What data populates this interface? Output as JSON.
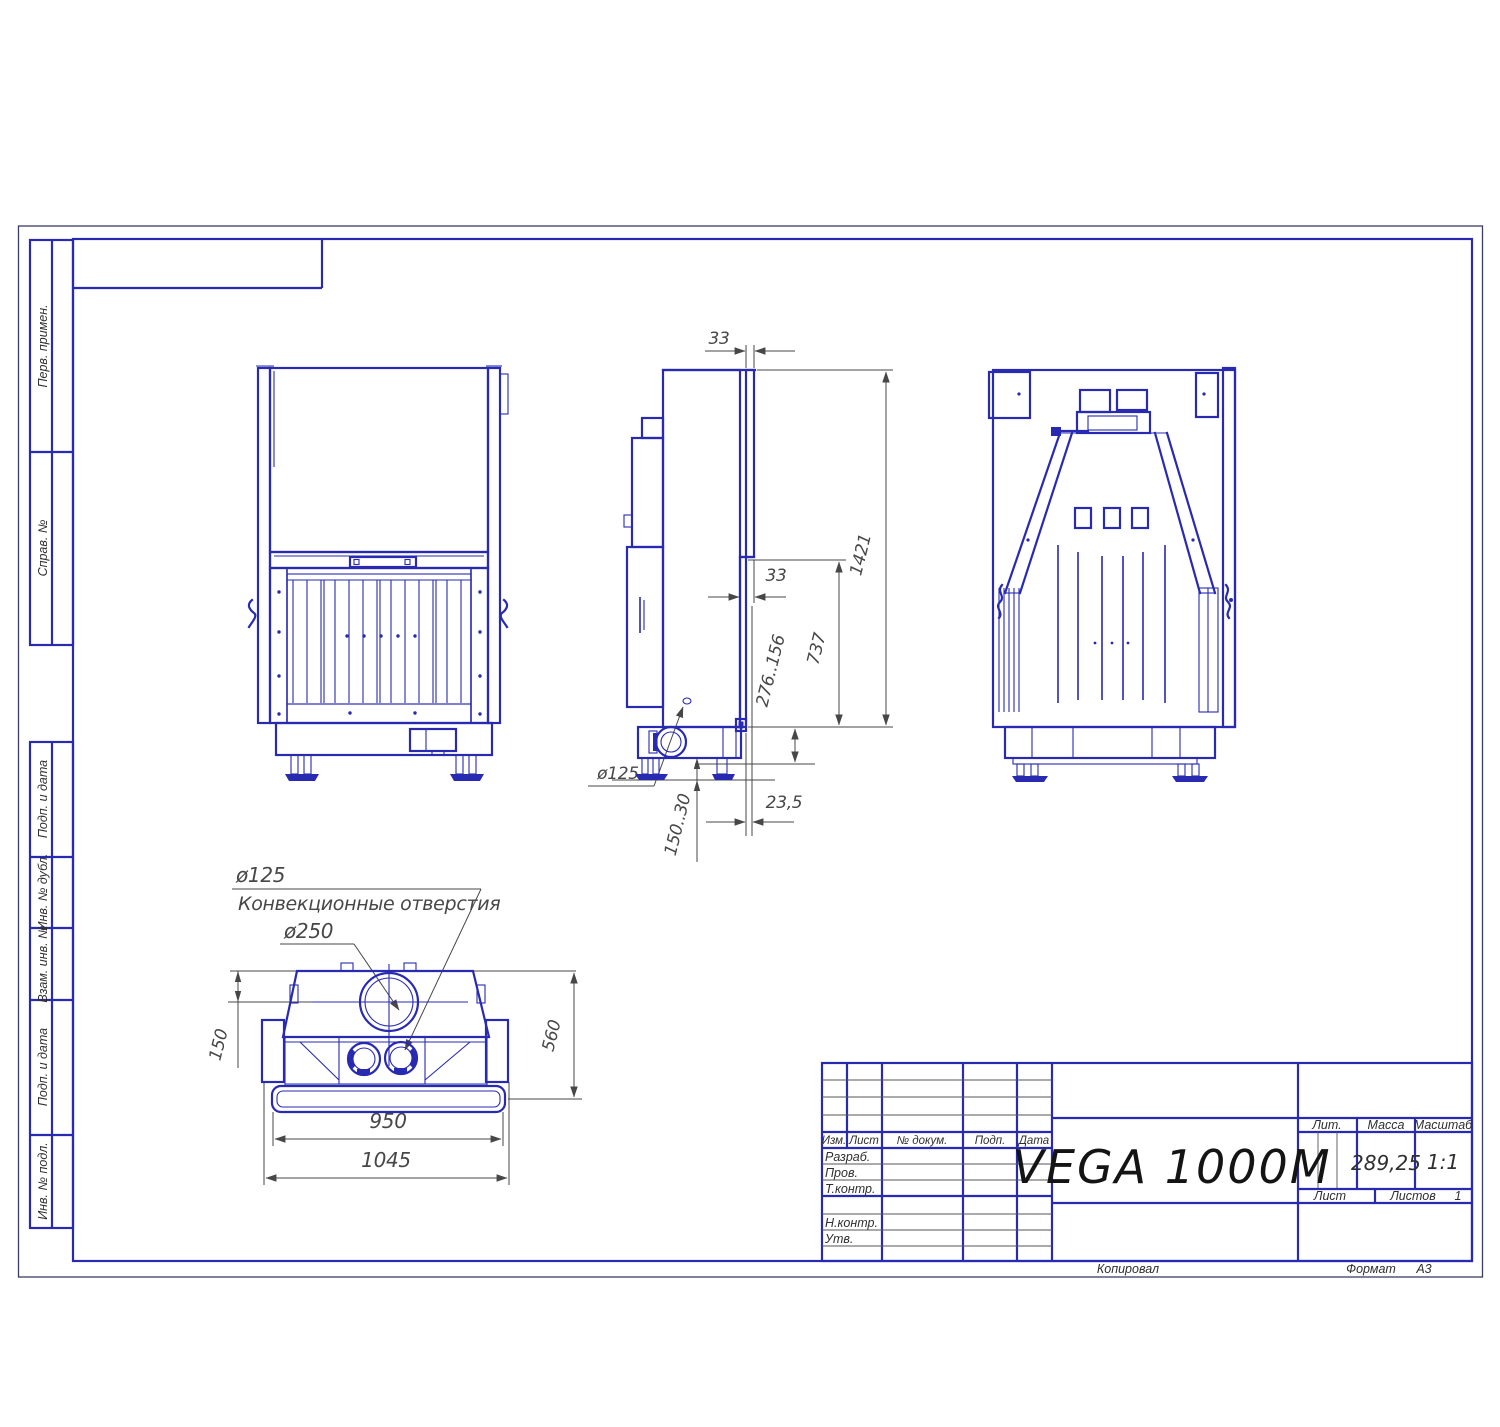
{
  "colors": {
    "line": "#282ab2",
    "dim": "#474747",
    "text": "#2f2f2f"
  },
  "sidebar": {
    "perv_primen": "Перв. примен.",
    "sprav_no": "Справ. №",
    "podp_i_data_1": "Подп. и дата",
    "inv_no_dubl": "Инв. № дубл.",
    "vzam_inv_no": "Взам. инв. №",
    "podp_i_data_2": "Подп. и дата",
    "inv_no_podl": "Инв. № подл."
  },
  "title_block": {
    "part_name": "VEGA 1000M",
    "col_izm": "Изм.",
    "col_list": "Лист",
    "col_doc": "№ докум.",
    "col_podp": "Подп.",
    "col_data": "Дата",
    "row_razrab": "Разраб.",
    "row_prov": "Пров.",
    "row_tkontr": "Т.контр.",
    "row_nkontr": "Н.контр.",
    "row_utv": "Утв.",
    "lit_label": "Лит.",
    "mass_label": "Масса",
    "scale_label": "Масштаб",
    "mass_value": "289,25",
    "scale_value": "1:1",
    "sheet_label": "Лист",
    "sheets_label": "Листов",
    "sheets_value": "1",
    "copied_by": "Копировал",
    "format_label": "Формат",
    "format_value": "А3"
  },
  "dimensions": {
    "glass_depth_top": "33",
    "ledge_depth": "33",
    "overall_height": "1421",
    "lower_front_height": "737",
    "base_height_range": "276..156",
    "side_spigot_dia": "ø125",
    "front_offset": "23,5",
    "leg_height_range": "150..30",
    "convection_dia": "ø125",
    "convection_label": "Конвекционные отверстия",
    "flue_dia": "ø250",
    "flue_offset": "150",
    "depth": "560",
    "front_width": "950",
    "overall_width": "1045"
  }
}
